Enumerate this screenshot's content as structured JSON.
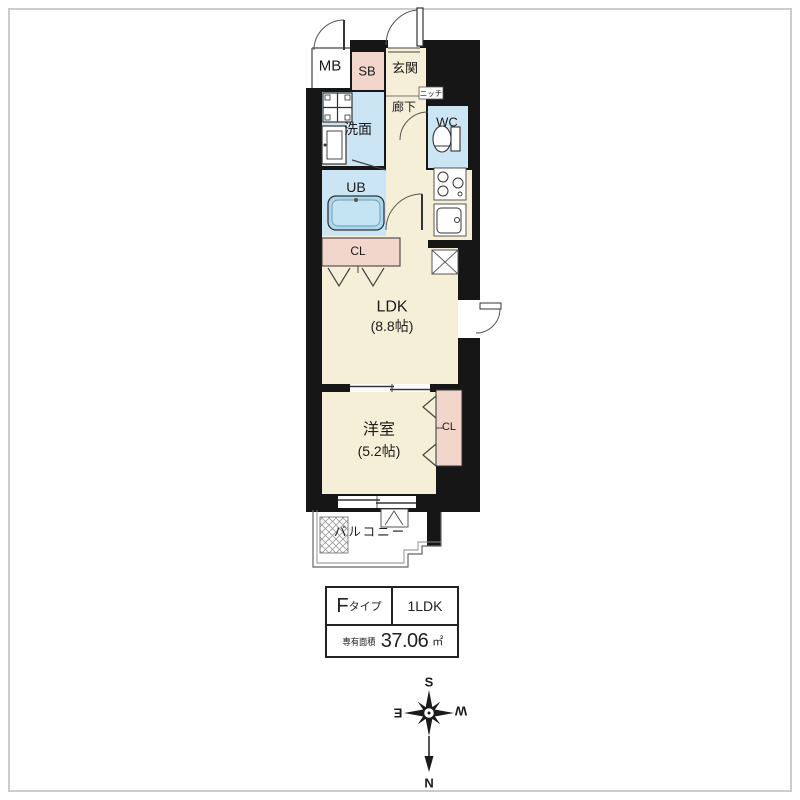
{
  "plan": {
    "mb": "MB",
    "sb": "SB",
    "genkan": "玄関",
    "senmen": "洗面",
    "rouka": "廊下",
    "niche": "ニッチ",
    "wc": "WC",
    "ub": "UB",
    "cl_upper": "CL",
    "ldk": "LDK",
    "ldk_size": "(8.8帖)",
    "yoshitsu": "洋室",
    "yoshitsu_size": "(5.2帖)",
    "cl_lower": "CL",
    "balcony": "バルコニー"
  },
  "spec_table": {
    "type_main": "F",
    "type_suffix": "タイプ",
    "layout": "1LDK",
    "area_label": "専有面積",
    "area_value": "37.06",
    "area_unit": "㎡"
  },
  "compass": {
    "n": "N",
    "s": "S",
    "e": "E",
    "w": "W"
  },
  "colors": {
    "wall": "#161616",
    "room_cream": "#f6efd8",
    "wet_blue": "#cbe5f4",
    "closet_pink": "#f2d6cb",
    "tub_blue": "#abd8ee",
    "thin_line": "#555555",
    "frame_gray": "#cccccc"
  }
}
